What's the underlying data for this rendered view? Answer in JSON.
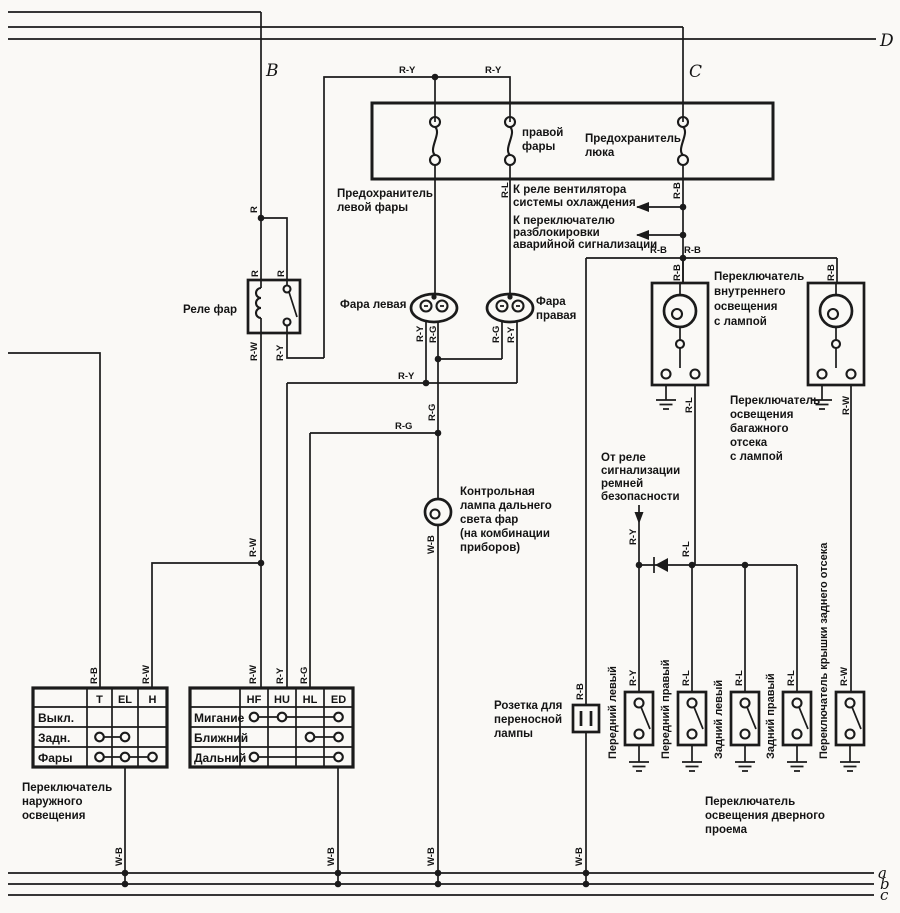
{
  "nodes": {
    "b": "B",
    "c": "C",
    "d": "D",
    "gnd_a": "a",
    "gnd_b": "b",
    "gnd_c": "c"
  },
  "wires": {
    "r": "R",
    "rw": "R-W",
    "ry": "R-Y",
    "rg": "R-G",
    "rb": "R-B",
    "rl": "R-L",
    "wb": "W-B"
  },
  "components": {
    "relay_label": "Реле фар",
    "fuse_left": [
      "Предохранитель",
      "левой фары"
    ],
    "fuse_right": [
      "правой",
      "фары"
    ],
    "fuse_hatch": [
      "Предохранитель",
      "люка"
    ],
    "lamp_left": "Фара левая",
    "lamp_right": [
      "Фара",
      "правая"
    ],
    "interior_switch": [
      "Переключатель",
      "внутреннего",
      "освещения",
      "с лампой"
    ],
    "luggage_switch": [
      "Переключатель",
      "освещения",
      "багажного",
      "отсека",
      "с лампой"
    ],
    "indicator": [
      "Контрольная",
      "лампа дальнего",
      "света фар",
      "(на комбинации",
      "приборов)"
    ],
    "socket": [
      "Розетка для",
      "переносной",
      "лампы"
    ],
    "exterior_switch": [
      "Переключатель",
      "наружного",
      "освещения"
    ],
    "door_label": [
      "Переключатель",
      "освещения дверного",
      "проема"
    ]
  },
  "notes": {
    "fan_relay": [
      "К реле вентилятора",
      "системы охлаждения"
    ],
    "hazard": [
      "К переключателю",
      "разблокировки",
      "аварийной сигнализации"
    ],
    "seat_belt": [
      "От реле",
      "сигнализации",
      "ремней",
      "безопасности"
    ]
  },
  "door_switches": [
    "Передний левый",
    "Передний правый",
    "Задний левый",
    "Задний правый",
    "Переключатель крышки заднего отсека"
  ],
  "tables": {
    "exterior_light": {
      "columns": [
        "T",
        "EL",
        "H"
      ],
      "rows": [
        "Выкл.",
        "Задн.",
        "Фары"
      ]
    },
    "dimmer": {
      "columns": [
        "HF",
        "HU",
        "HL",
        "ED"
      ],
      "rows": [
        "Мигание",
        "Ближний",
        "Дальний"
      ]
    }
  }
}
